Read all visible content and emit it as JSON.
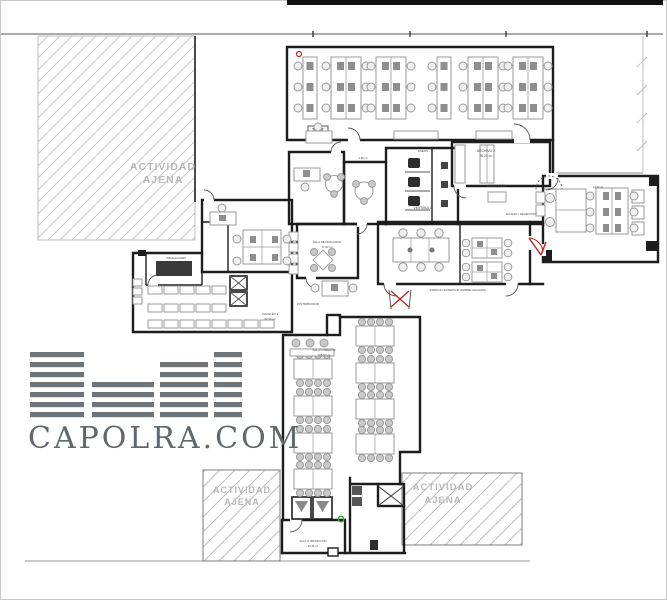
{
  "external_area": {
    "line1": "ACTIVIDAD",
    "line2": "AJENA"
  },
  "watermark": {
    "brand": "CAPOLRA.COM"
  },
  "labels": {
    "archivo_name": "ARCHIVO 2",
    "archivo_area": "35,20 m²",
    "aseos": "ASEOS",
    "meeting_area": "4,35 m²",
    "recepcion": "RECEPCIÓN",
    "mantenimiento": "MANTENIM.",
    "vestibulo": "VESTÍBULO",
    "acceso": "ACCESO / RECEPCIÓN",
    "despacho_area": "24,60 m²",
    "descanso_name": "SALA DE DESCANSO",
    "descanso_area": "17,30 m²",
    "distribuidor": "DISTRIBUIDOR",
    "almacen_name": "ALMACÉN 1",
    "almacen_area": "32,30 m²",
    "instalaciones": "INSTALACIONES",
    "comedor_name": "SALA COMEDOR",
    "comedor_area": "108,50 m²",
    "clima_name": "SALA CLIMATIZACIÓN",
    "clima_area": "20,45 m²",
    "exterior": "ESPACIO EXTERIOR (SOBRE VACIADO)"
  },
  "colors": {
    "wall": "#1d1d1d",
    "furniture": "#9a9a9a",
    "hatch": "#c8c8c8",
    "watermark": "#6e7478",
    "door_red": "#b3271e",
    "marker_green": "#36a23a"
  }
}
